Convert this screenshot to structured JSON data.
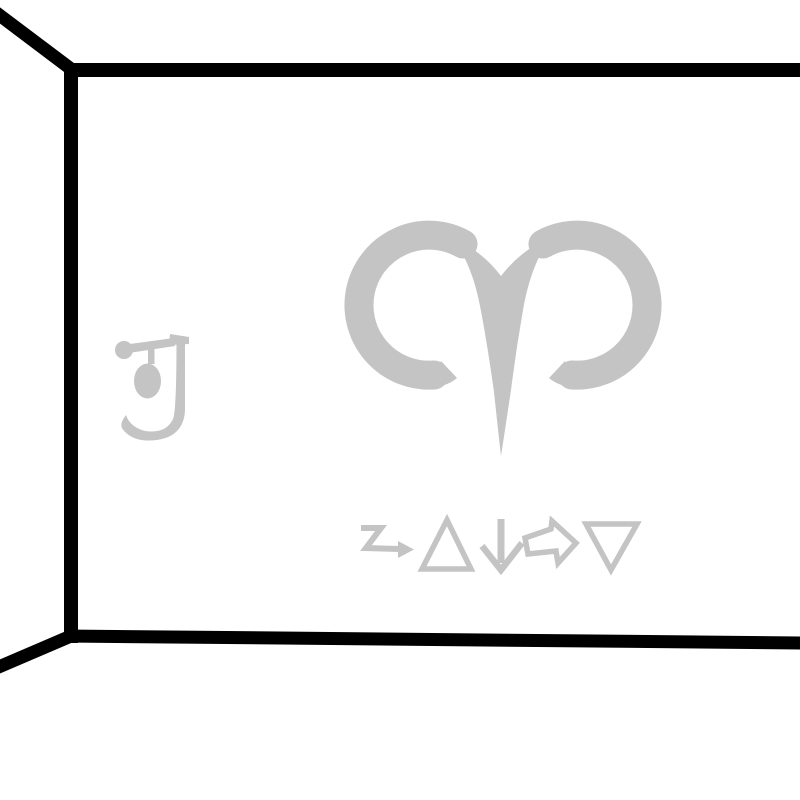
{
  "scene": {
    "name": "perspective-wall-with-glyphs",
    "background_color": "#ffffff"
  },
  "colors": {
    "line": "#000000",
    "glyph": "#c4c4c4"
  },
  "wall": {
    "edges": [
      {
        "name": "ceiling-corner-line"
      },
      {
        "name": "wall-top-edge"
      },
      {
        "name": "wall-left-edge"
      },
      {
        "name": "wall-bottom-edge"
      },
      {
        "name": "floor-corner-line"
      }
    ],
    "glyphs": [
      {
        "name": "j-glyph",
        "description": "serif J with ball terminal, top bar and hanging oval"
      },
      {
        "name": "aries-symbol",
        "description": "large ram-horns zodiac sign",
        "unicode": "♈"
      },
      {
        "name": "step-arrow-icon",
        "unicode": "↳"
      },
      {
        "name": "triangle-up-icon",
        "unicode": "△"
      },
      {
        "name": "arrow-down-icon",
        "unicode": "↓"
      },
      {
        "name": "block-arrow-right-icon",
        "unicode": "⇨"
      },
      {
        "name": "triangle-down-icon",
        "unicode": "▽"
      }
    ]
  }
}
